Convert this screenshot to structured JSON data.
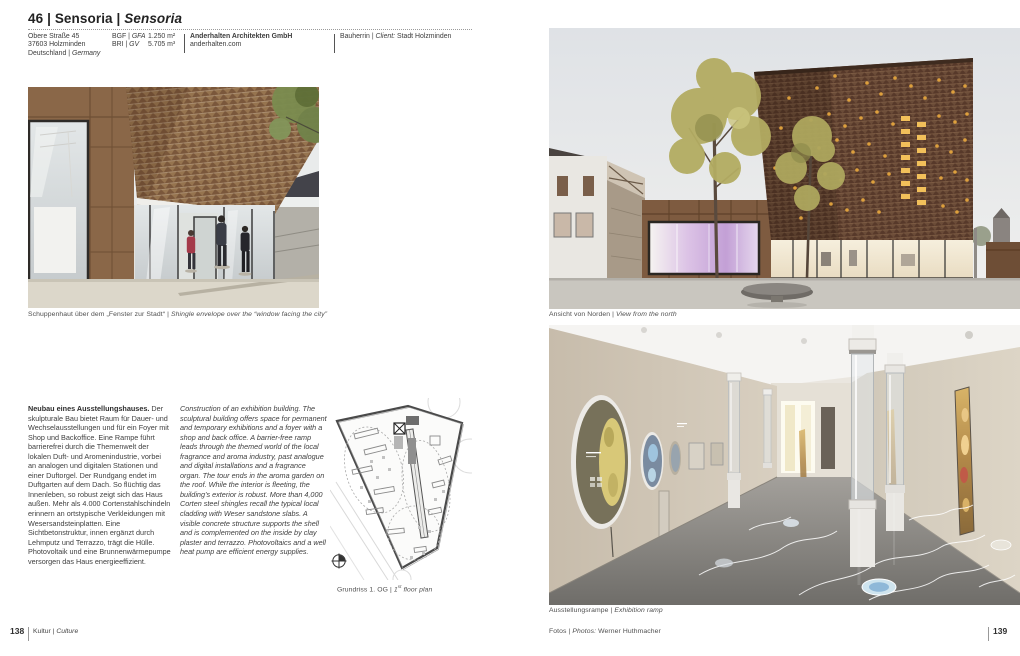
{
  "sep": "|",
  "header": {
    "number": "46",
    "title_de": "Sensoria",
    "title_en": "Sensoria",
    "address_line1": "Obere Straße 45",
    "address_line2": "37603 Holzminden",
    "country_de": "Deutschland",
    "country_en": "Germany",
    "metrics": [
      {
        "label_de": "BGF",
        "label_en": "GFA",
        "value": "1.250 m²"
      },
      {
        "label_de": "BRI",
        "label_en": "GV",
        "value": "5.705 m³"
      }
    ],
    "architect": "Anderhalten Architekten GmbH",
    "website": "anderhalten.com",
    "client_label_de": "Bauherrin",
    "client_label_en": "Client:",
    "client_value": "Stadt Holzminden"
  },
  "captions": {
    "street_de": "Schuppenhaut über dem „Fenster zur Stadt“",
    "street_en": "Shingle envelope over the “window facing the city”",
    "north_de": "Ansicht von Norden",
    "north_en": "View from the north",
    "ramp_de": "Ausstellungsrampe",
    "ramp_en": "Exhibition ramp"
  },
  "plan_caption": {
    "de": "Grundriss 1. OG",
    "en_num": "1",
    "en_sup": "st",
    "en_rest": " floor plan"
  },
  "body_de": {
    "lead": "Neubau eines Ausstellungshauses.",
    "text": "Der skulpturale Bau bietet Raum für Dauer- und Wechselausstellungen und für ein Foyer mit Shop und Backoffice. Eine Rampe führt barrierefrei durch die Themenwelt der lokalen Duft- und Aromenindustrie, vorbei an analogen und digitalen Stationen und einer Duftorgel. Der Rundgang endet im Duftgarten auf dem Dach. So flüchtig das Innenleben, so robust zeigt sich das Haus außen. Mehr als 4.000 Cortenstahlschindeln erinnern an ortstypische Verkleidungen mit Wesersandsteinplatten. Eine Sichtbetonstruktur, innen ergänzt durch Lehmputz und Terrazzo, trägt die Hülle. Photovoltaik und eine Brunnenwärmepumpe versorgen das Haus energieeffizient."
  },
  "body_en": {
    "lead": "Construction of an exhibition building.",
    "text": "The sculptural building offers space for permanent and temporary exhibitions and a foyer with a shop and back office. A barrier-free ramp leads through the themed world of the local fragrance and aroma industry, past analogue and digital installations and a fragrance organ. The tour ends in the aroma garden on the roof. While the interior is fleeting, the building’s exterior is robust. More than 4,000 Corten steel shingles recall the typical local cladding with Weser sandstone slabs. A visible concrete structure supports the shell and is complemented on the inside by clay plaster and terrazzo. Photovoltaics and a well heat pump are efficient energy supplies."
  },
  "credit": {
    "label_de": "Fotos",
    "label_en": "Photos:",
    "value": "Werner Huthmacher"
  },
  "footer": {
    "page_left": "138",
    "section_de": "Kultur",
    "section_en": "Culture",
    "page_right": "139"
  },
  "colors": {
    "corten": "#8a6748",
    "corten_dark": "#6b4c38",
    "autumn_foliage": "#b3ac62",
    "lavender_window": "#c4a0d8",
    "interior_wall": "#cdc3b2",
    "terrazzo_floor": "#8f8d89",
    "amber_window_glow": "#e0a845",
    "sky": "#e4e7e9",
    "caption_text": "#4f4f4f"
  }
}
